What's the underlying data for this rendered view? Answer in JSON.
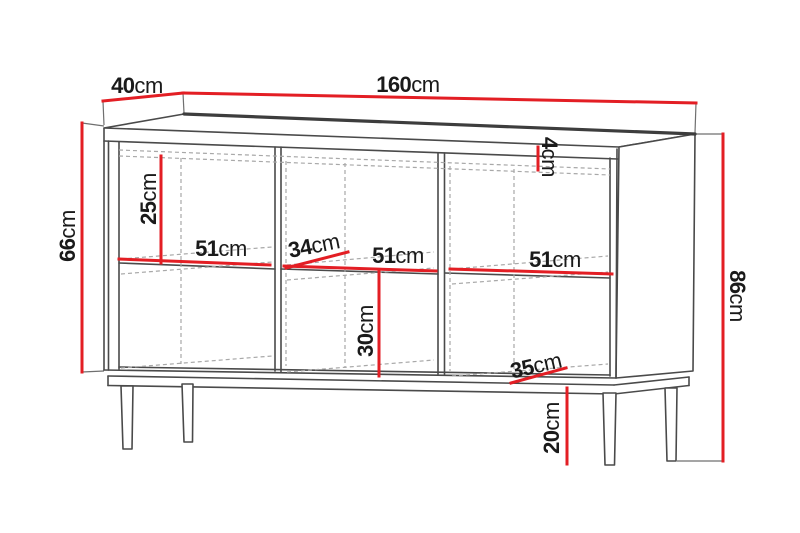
{
  "drawing": {
    "type": "furniture-dimension-diagram",
    "subject": "sideboard with three compartments, middle shelf and four legs",
    "unit": "cm",
    "dimensions": {
      "top_depth": {
        "value": "40",
        "unit": "cm"
      },
      "top_width": {
        "value": "160",
        "unit": "cm"
      },
      "body_height": {
        "value": "66",
        "unit": "cm"
      },
      "total_height": {
        "value": "86",
        "unit": "cm"
      },
      "upper_compartment_height": {
        "value": "25",
        "unit": "cm"
      },
      "compartment_width_left": {
        "value": "51",
        "unit": "cm"
      },
      "shelf_depth": {
        "value": "34",
        "unit": "cm"
      },
      "compartment_width_middle": {
        "value": "51",
        "unit": "cm"
      },
      "compartment_width_right": {
        "value": "51",
        "unit": "cm"
      },
      "lower_compartment_height": {
        "value": "30",
        "unit": "cm"
      },
      "bottom_depth": {
        "value": "35",
        "unit": "cm"
      },
      "top_panel_thickness": {
        "value": "4",
        "unit": "cm"
      },
      "leg_height": {
        "value": "20",
        "unit": "cm"
      }
    },
    "colors": {
      "dimension_line": "#e31e24",
      "outline": "#4a4a4a",
      "hidden_line": "#a8a8a8",
      "label_text": "#1a1a1a",
      "background": "#ffffff"
    }
  }
}
